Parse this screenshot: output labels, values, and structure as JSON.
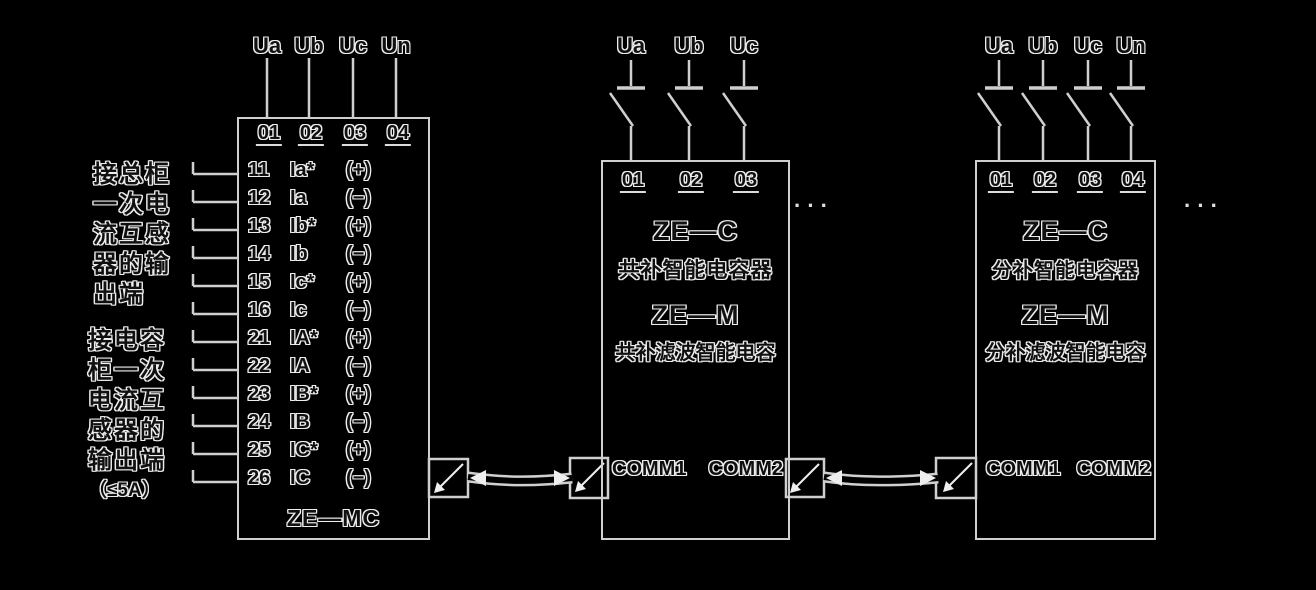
{
  "colors": {
    "background": "#000000",
    "line_color": "#cfcfcf",
    "text_outline": "#ededed"
  },
  "left_block": {
    "model": "ZE—MC",
    "phase_labels": [
      "Ua",
      "Ub",
      "Uc",
      "Un"
    ],
    "terminals": [
      "01",
      "02",
      "03",
      "04"
    ],
    "rows": [
      {
        "no": "11",
        "signal": "Ia*",
        "polarity": "(+)"
      },
      {
        "no": "12",
        "signal": "Ia",
        "polarity": "(−)"
      },
      {
        "no": "13",
        "signal": "Ib*",
        "polarity": "(+)"
      },
      {
        "no": "14",
        "signal": "Ib",
        "polarity": "(−)"
      },
      {
        "no": "15",
        "signal": "Ic*",
        "polarity": "(+)"
      },
      {
        "no": "16",
        "signal": "Ic",
        "polarity": "(−)"
      },
      {
        "no": "21",
        "signal": "IA*",
        "polarity": "(+)"
      },
      {
        "no": "22",
        "signal": "IA",
        "polarity": "(−)"
      },
      {
        "no": "23",
        "signal": "IB*",
        "polarity": "(+)"
      },
      {
        "no": "24",
        "signal": "IB",
        "polarity": "(−)"
      },
      {
        "no": "25",
        "signal": "IC*",
        "polarity": "(+)"
      },
      {
        "no": "26",
        "signal": "IC",
        "polarity": "(−)"
      }
    ],
    "note_top_lines": [
      "接总柜",
      "一次电",
      "流互感",
      "器的输",
      "出端"
    ],
    "note_bottom_lines": [
      "接电容",
      "柜一次",
      "电流互",
      "感器的",
      "输出端",
      "（≤5A）"
    ]
  },
  "middle_block": {
    "phase_labels": [
      "Ua",
      "Ub",
      "Uc"
    ],
    "terminals": [
      "01",
      "02",
      "03"
    ],
    "model_1": "ZE—C",
    "desc_1": "共补智能电容器",
    "model_2": "ZE—M",
    "desc_2": "共补滤波智能电容",
    "comm_1": "COMM1",
    "comm_2": "COMM2"
  },
  "right_block": {
    "phase_labels": [
      "Ua",
      "Ub",
      "Uc",
      "Un"
    ],
    "terminals": [
      "01",
      "02",
      "03",
      "04"
    ],
    "model_1": "ZE—C",
    "desc_1": "分补智能电容器",
    "model_2": "ZE—M",
    "desc_2": "分补滤波智能电容",
    "comm_1": "COMM1",
    "comm_2": "COMM2"
  },
  "ellipsis": "···"
}
